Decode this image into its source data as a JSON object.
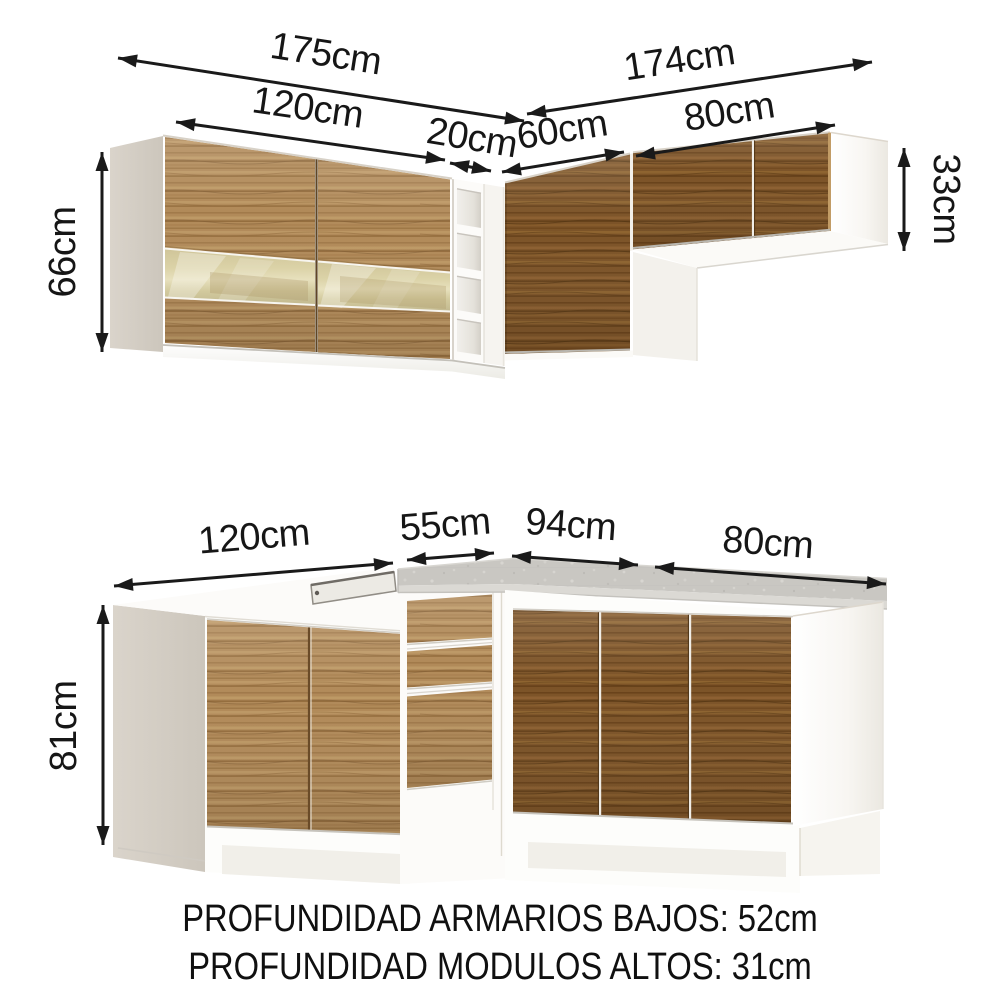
{
  "upper": {
    "total_left": "175cm",
    "doors": "120cm",
    "shelf": "20cm",
    "total_right": "174cm",
    "corner": "60cm",
    "right": "80cm",
    "height": "66cm",
    "right_height": "33cm"
  },
  "lower": {
    "doors": "120cm",
    "corner": "55cm",
    "right_doors": "94cm",
    "right": "80cm",
    "height": "81cm"
  },
  "notes": {
    "line1": "PROFUNDIDAD ARMARIOS BAJOS: 52cm",
    "line2": "PROFUNDIDAD MODULOS ALTOS: 31cm"
  },
  "colors": {
    "wood_light": "#b18a59",
    "wood_dark": "#7c5327",
    "glass": "#ded5a8",
    "countertop": "#c9c7c2",
    "carcass_white": "#fdfdfb",
    "side_panel": "#d8d2c9",
    "dimension_ink": "#1a1a1a",
    "background": "#ffffff"
  }
}
